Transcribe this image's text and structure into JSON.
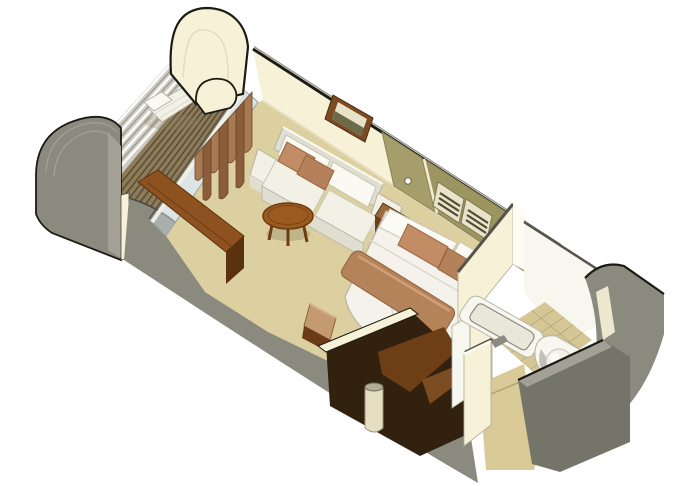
{
  "meta": {
    "title": "Stateroom isometric cutaway floor plan rendering",
    "view": "3D axonometric cutaway, no visible text",
    "canvas": {
      "width": 680,
      "height": 486
    }
  },
  "scene": {
    "rooms": [
      {
        "name": "veranda",
        "features": [
          "teak slat deck",
          "open railing",
          "white lounge chair",
          "curved hull bulkhead",
          "privacy partition wall"
        ]
      },
      {
        "name": "living-area",
        "features": [
          "sliding glass door",
          "brown drape panels",
          "cream sofa with two brown throw pillows",
          "framed artwork",
          "round wood coffee table",
          "built-in desk",
          "desk chair"
        ]
      },
      {
        "name": "sleeping-area",
        "features": [
          "bed with rounded foot",
          "two white pillows",
          "two brown accent pillows",
          "brown bed runner",
          "nightstand",
          "khaki closet door with knob",
          "khaki headboard wall with two louver vents",
          "open wardrobe",
          "column"
        ]
      },
      {
        "name": "bathroom",
        "features": [
          "bathtub",
          "toilet with curved counter",
          "tiled floor",
          "white partition walls"
        ]
      },
      {
        "name": "entry",
        "features": [
          "tiled corridor",
          "doorway between grey walls"
        ]
      }
    ]
  },
  "colors": {
    "bg": "#ffffff",
    "outline": "#1b1b14",
    "outline-soft": "#4a4a40",
    "gray-wall": "#8a8a7f",
    "gray-wall-light": "#a3a196",
    "gray-wall-dark": "#757468",
    "gray-cap": "#55544a",
    "cream-wall": "#f7f1d8",
    "cream-shade": "#e6ddbd",
    "cream-edge": "#fdfcf4",
    "floor": "#dcd0a0",
    "tile": "#d5c795",
    "tile-line": "#b2a478",
    "corridor": "#d9ca97",
    "deck": "#8c7c5c",
    "deck-slat": "#5a4c31",
    "rail-base": "#cbcbc3",
    "rail-white": "#fbfbf7",
    "rail-dark": "#8e8e84",
    "glass": "#c3ced0",
    "glass-frame": "#eef0ea",
    "curtain-a": "#a87a52",
    "curtain-b": "#8a5e3a",
    "curtain-edge": "#6e4426",
    "sofa": "#f3f1e6",
    "sofa-shade": "#e0ded0",
    "sofa-edge": "#b5b3a4",
    "cushion-hi": "#fbfaf2",
    "pillow-a": "#c28c64",
    "pillow-b": "#b5815a",
    "pillow-edge": "#96643e",
    "table-wood": "#9b5a1f",
    "table-wood-dark": "#6f3c10",
    "desk-top": "#8e5120",
    "desk-dark": "#5a320d",
    "night-top": "#9a6a3a",
    "night-front": "#6e4016",
    "night-side": "#835222",
    "khaki": "#a59d6a",
    "khaki-b": "#9d9560",
    "khaki-trim": "#f2ecd6",
    "vent-frame": "#e9e3cb",
    "vent-slat": "#4f4a30",
    "frame-wood": "#7c4b22",
    "art-light": "#e8e2c8",
    "art-dark": "#6b6b4a",
    "bed-white": "#f4f2ea",
    "bed-fold": "#dcd9cc",
    "band": "#b5835a",
    "band-hi": "#cfa077",
    "band-edge": "#8e6038",
    "pillow-white": "#fbfaf4",
    "wardrobe-dark": "#33210f",
    "wardrobe-shelf": "#6e3f16",
    "wardrobe-shelf-hi": "#8a5526",
    "column-body": "#e6dec2",
    "column-top": "#b3ad97",
    "fixture": "#f7f6ef",
    "fixture-shade": "#e9e7da",
    "fixture-edge": "#b3b1a3",
    "chair-tan": "#c49a70",
    "chair-dark": "#6b3a16",
    "shadow": "#8a8060"
  }
}
